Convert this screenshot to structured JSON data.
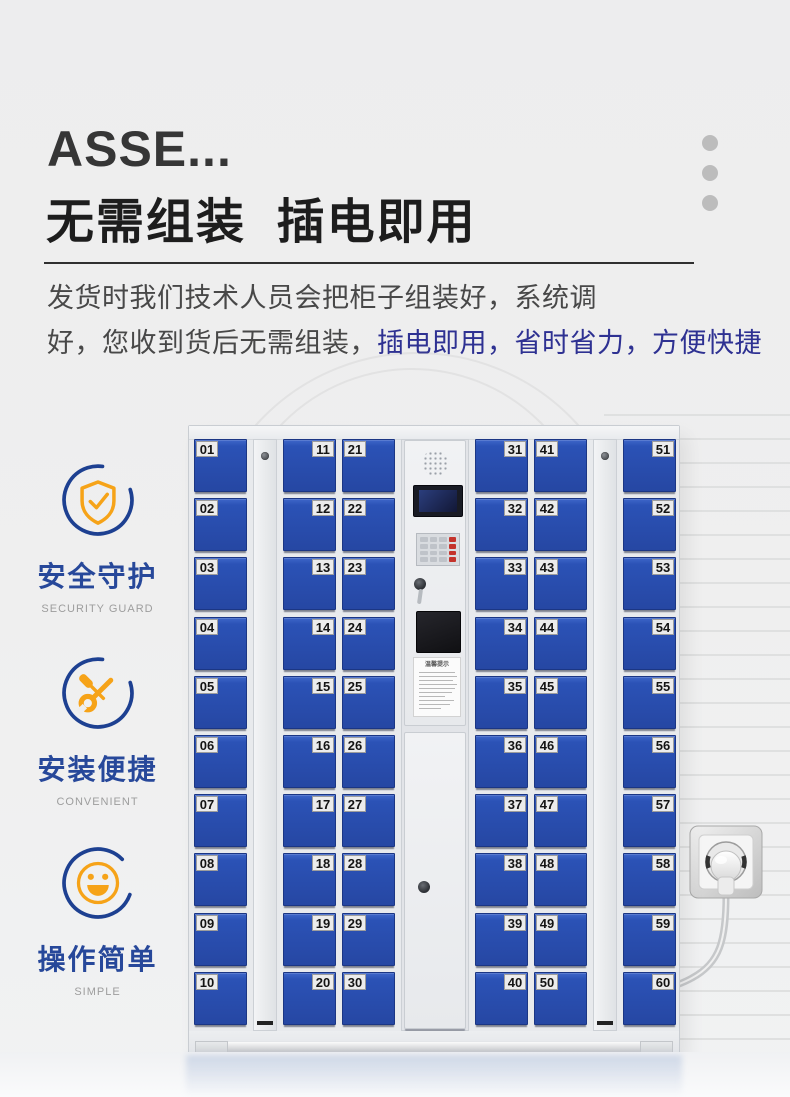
{
  "hero": {
    "brand_title": "ASSE...",
    "heading": "无需组装  插电即用",
    "description_line1": "发货时我们技术人员会把柜子组装好，系统调",
    "description_line2_dark": "好，您收到货后无需组装，",
    "description_line2_blue": "插电即用，省时省力，方便快捷"
  },
  "features": [
    {
      "title": "安全守护",
      "subtitle": "SECURITY GUARD",
      "icon": "shield-check-icon"
    },
    {
      "title": "安装便捷",
      "subtitle": "CONVENIENT",
      "icon": "tools-icon"
    },
    {
      "title": "操作简单",
      "subtitle": "SIMPLE",
      "icon": "smiley-icon"
    }
  ],
  "locker": {
    "columns": [
      {
        "type": "doors",
        "label_side": "left",
        "doors": [
          "01",
          "02",
          "03",
          "04",
          "05",
          "06",
          "07",
          "08",
          "09",
          "10"
        ]
      },
      {
        "type": "filler"
      },
      {
        "type": "doors",
        "label_side": "right",
        "doors": [
          "11",
          "12",
          "13",
          "14",
          "15",
          "16",
          "17",
          "18",
          "19",
          "20"
        ]
      },
      {
        "type": "doors",
        "label_side": "left",
        "doors": [
          "21",
          "22",
          "23",
          "24",
          "25",
          "26",
          "27",
          "28",
          "29",
          "30"
        ]
      },
      {
        "type": "control"
      },
      {
        "type": "doors",
        "label_side": "right",
        "doors": [
          "31",
          "32",
          "33",
          "34",
          "35",
          "36",
          "37",
          "38",
          "39",
          "40"
        ]
      },
      {
        "type": "doors",
        "label_side": "left",
        "doors": [
          "41",
          "42",
          "43",
          "44",
          "45",
          "46",
          "47",
          "48",
          "49",
          "50"
        ]
      },
      {
        "type": "filler"
      },
      {
        "type": "doors",
        "label_side": "right",
        "doors": [
          "51",
          "52",
          "53",
          "54",
          "55",
          "56",
          "57",
          "58",
          "59",
          "60"
        ]
      }
    ],
    "control_panel": {
      "sticker_title": "温馨提示"
    }
  },
  "colors": {
    "door_blue": "#2b52b6",
    "accent_orange": "#f6a318",
    "icon_circle_blue": "#1d4091",
    "feature_title_blue": "#27489a",
    "highlight_text_blue": "#2e3192"
  }
}
